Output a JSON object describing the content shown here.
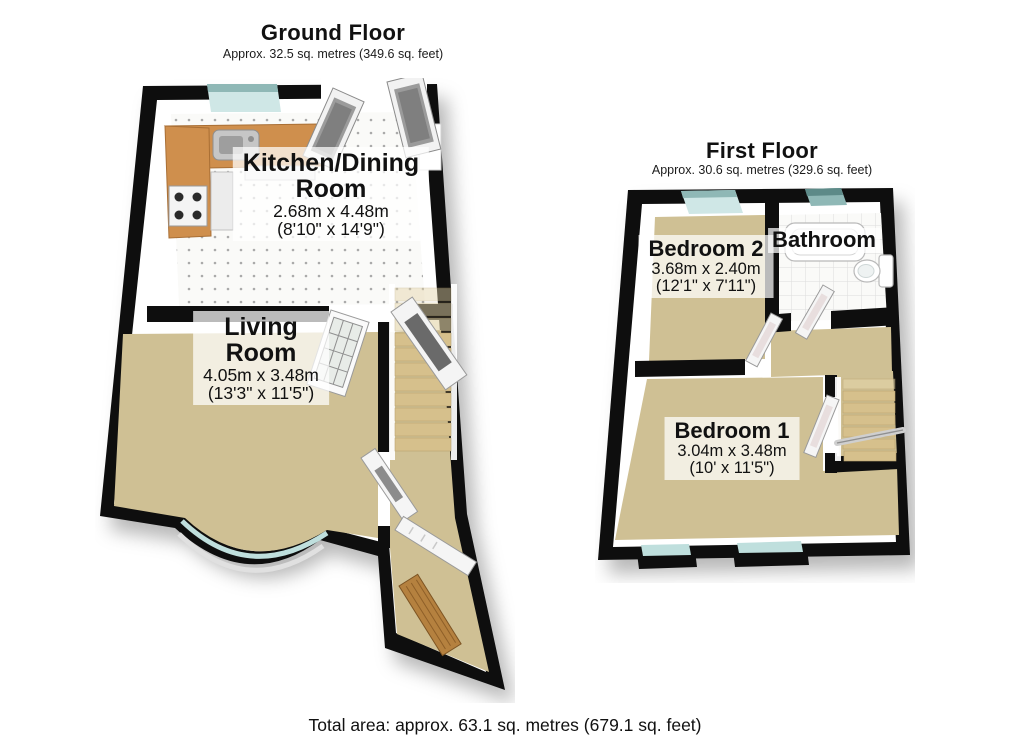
{
  "colors": {
    "wall": "#0e0e0e",
    "carpet": "#cfc094",
    "tile_floor": "#fafaf8",
    "counter_wood": "#cf8f4d",
    "front_door_wood": "#b5813f",
    "window_glass": "#bfdfdd",
    "window_glass_light": "#cfe7e6",
    "window_glass_dark": "#8fb8b6",
    "stair_tread": "#d6c08c"
  },
  "ground_floor": {
    "title": "Ground Floor",
    "subtitle": "Approx. 32.5 sq. metres (349.6 sq. feet)",
    "kitchen": {
      "name_line1": "Kitchen/Dining",
      "name_line2": "Room",
      "metric": "2.68m x 4.48m",
      "imperial": "(8'10\" x 14'9\")"
    },
    "living": {
      "name_line1": "Living",
      "name_line2": "Room",
      "metric": "4.05m x 3.48m",
      "imperial": "(13'3\" x 11'5\")"
    }
  },
  "first_floor": {
    "title": "First Floor",
    "subtitle": "Approx. 30.6 sq. metres (329.6 sq. feet)",
    "bedroom2": {
      "name": "Bedroom 2",
      "metric": "3.68m x 2.40m",
      "imperial": "(12'1\" x 7'11\")"
    },
    "bathroom": {
      "name": "Bathroom"
    },
    "bedroom1": {
      "name": "Bedroom 1",
      "metric": "3.04m x 3.48m",
      "imperial": "(10' x 11'5\")"
    }
  },
  "footer": {
    "total_area": "Total area: approx. 63.1 sq. metres (679.1 sq. feet)"
  }
}
